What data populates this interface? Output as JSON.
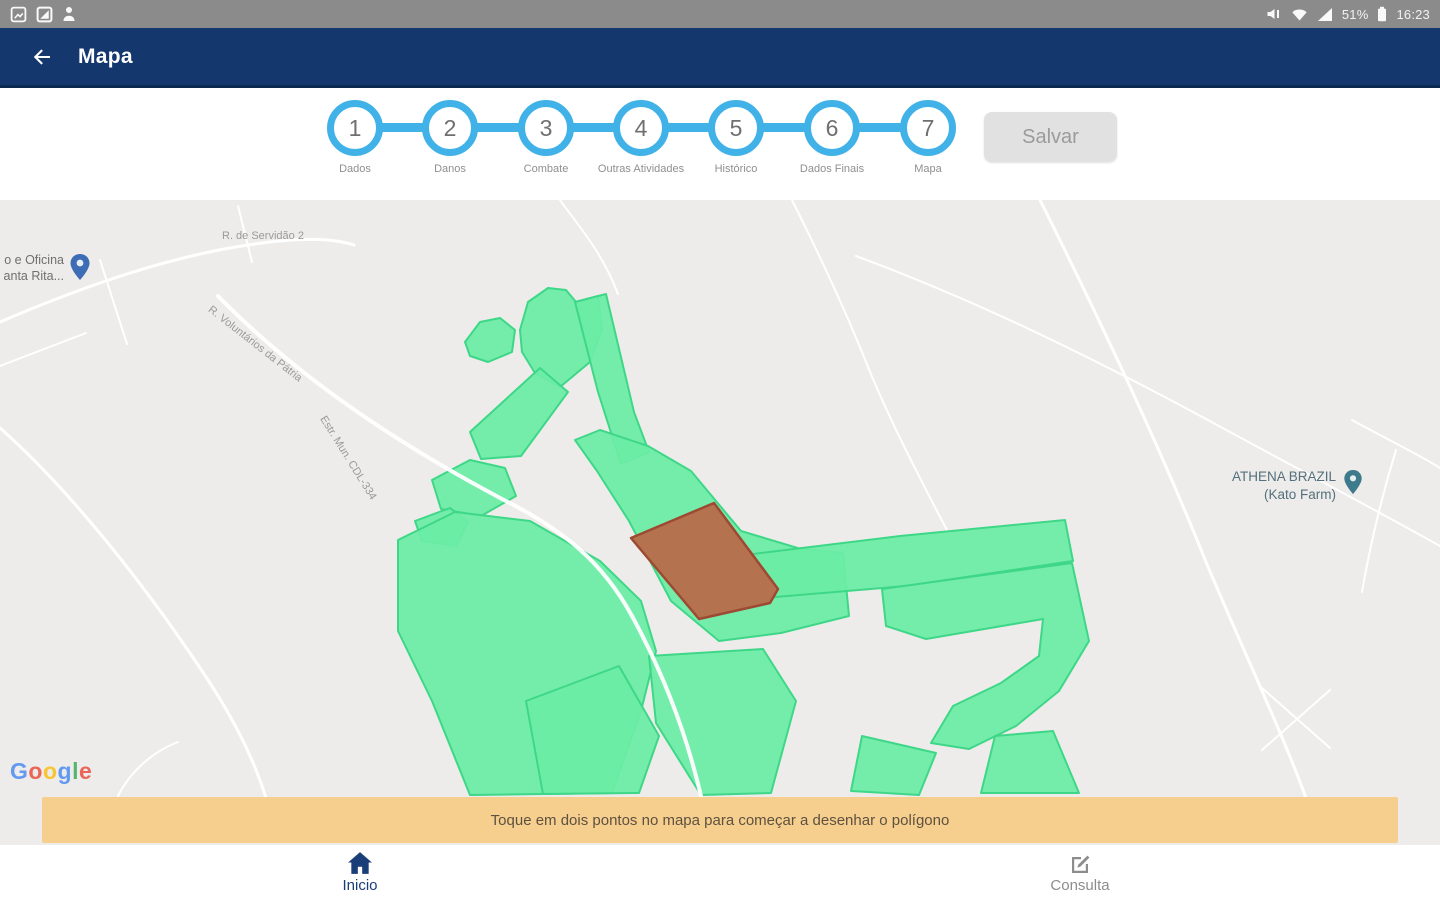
{
  "status_bar": {
    "time": "16:23",
    "battery_pct": "51%",
    "left_icons": [
      "screenshot-icon",
      "screenshot-icon",
      "person-icon"
    ],
    "right_icons": [
      "mute-icon",
      "wifi-icon",
      "cellular-icon",
      "battery-icon"
    ]
  },
  "header": {
    "title": "Mapa",
    "back_icon": "arrow-left-icon"
  },
  "stepper": {
    "steps": [
      {
        "num": "1",
        "label": "Dados"
      },
      {
        "num": "2",
        "label": "Danos"
      },
      {
        "num": "3",
        "label": "Combate"
      },
      {
        "num": "4",
        "label": "Outras Atividades"
      },
      {
        "num": "5",
        "label": "Histórico"
      },
      {
        "num": "6",
        "label": "Dados Finais"
      },
      {
        "num": "7",
        "label": "Mapa"
      }
    ],
    "save_label": "Salvar"
  },
  "map": {
    "labels": {
      "street_top": "R. de Servidão 2",
      "poi_left_line1": "o e Oficina",
      "poi_left_line2": "anta Rita...",
      "street_diag1": "R. Voluntários da Pátria",
      "street_diag2": "Estr. Mun. CDL-334",
      "poi_right_line1": "ATHENA BRAZIL",
      "poi_right_line2": "(Kato Farm)"
    },
    "google_letters": [
      "G",
      "o",
      "o",
      "g",
      "l",
      "e"
    ]
  },
  "banner": {
    "text": "Toque em dois pontos no mapa para começar a desenhar o polígono"
  },
  "bottom_nav": {
    "items": [
      {
        "label": "Inicio",
        "icon": "home-icon"
      },
      {
        "label": "Consulta",
        "icon": "edit-icon"
      }
    ]
  },
  "colors": {
    "polygon_green": "#6CEDA5",
    "polygon_green_border": "#3ED788",
    "selected_polygon_brown": "#B5724F",
    "selected_polygon_border": "#9D4A33",
    "accent_blue": "#41B2E8",
    "header_navy": "#14376E",
    "banner_orange": "#F6CF8E"
  }
}
